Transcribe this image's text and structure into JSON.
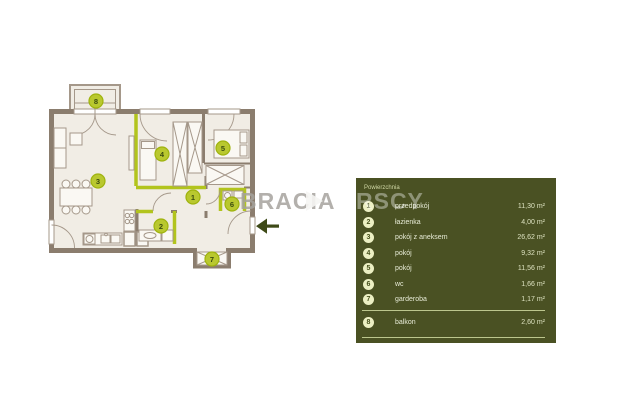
{
  "watermark": {
    "part1": "BRACIA",
    "part2": "RSCY"
  },
  "legend": {
    "title": "Powierzchnia",
    "rows": [
      {
        "number": "1",
        "label": "przedpokój",
        "area": "11,30 m²"
      },
      {
        "number": "2",
        "label": "łazienka",
        "area": "4,00 m²"
      },
      {
        "number": "3",
        "label": "pokój z aneksem",
        "area": "26,62 m²"
      },
      {
        "number": "4",
        "label": "pokój",
        "area": "9,32 m²"
      },
      {
        "number": "5",
        "label": "pokój",
        "area": "11,56 m²"
      },
      {
        "number": "6",
        "label": "wc",
        "area": "1,66 m²"
      },
      {
        "number": "7",
        "label": "garderoba",
        "area": "1,17 m²"
      },
      {
        "number": "8",
        "label": "balkon",
        "area": "2,60 m²"
      }
    ]
  },
  "plan": {
    "markers": [
      {
        "number": "1",
        "room": "przedpokój"
      },
      {
        "number": "2",
        "room": "łazienka"
      },
      {
        "number": "3",
        "room": "pokój z aneksem"
      },
      {
        "number": "4",
        "room": "pokój"
      },
      {
        "number": "5",
        "room": "pokój"
      },
      {
        "number": "6",
        "room": "wc"
      },
      {
        "number": "7",
        "room": "garderoba"
      },
      {
        "number": "8",
        "room": "balkon"
      }
    ],
    "entrance_arrow": "left"
  },
  "colors": {
    "accent_lime": "#b2c41d",
    "wall": "#8b7d6e",
    "plan_background": "#f1ede5",
    "table_background": "#4a5123",
    "arrow": "#3e4a17"
  }
}
